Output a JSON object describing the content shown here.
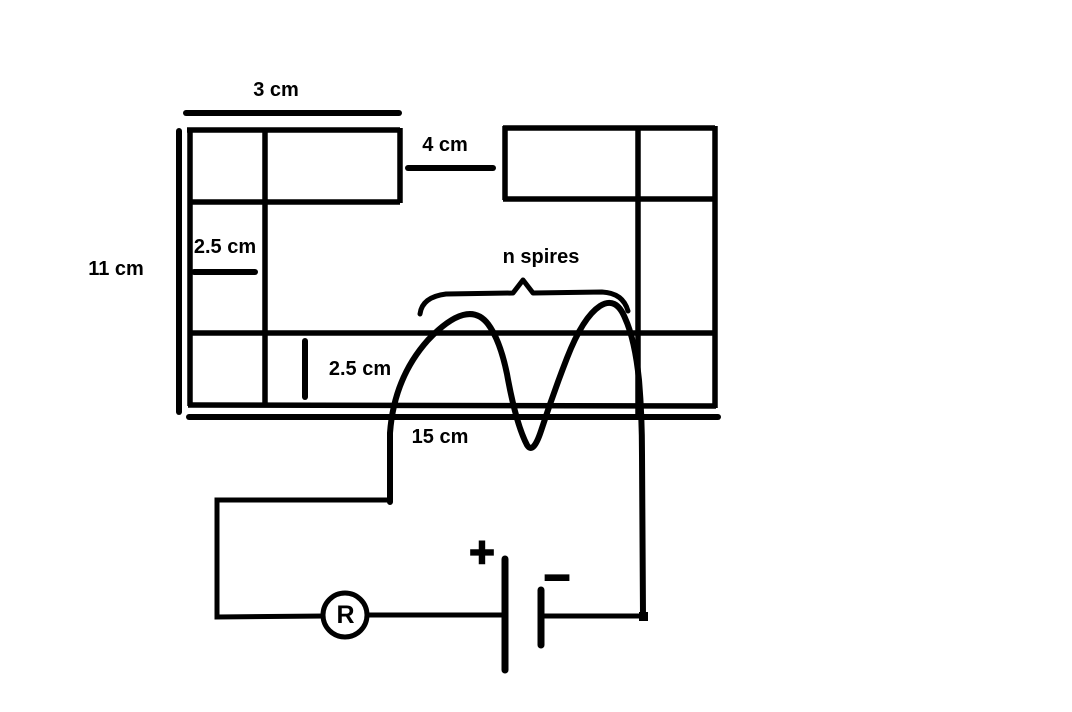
{
  "canvas": {
    "background": "#ffffff",
    "ink": "#000000"
  },
  "core": {
    "dimension_labels": {
      "top_segment_width": "3 cm",
      "air_gap_width": "4 cm",
      "left_limb_width": "2.5 cm",
      "total_height": "11 cm",
      "bottom_limb_thickness": "2.5 cm",
      "total_width": "15 cm"
    }
  },
  "coil": {
    "label": "n spires"
  },
  "circuit": {
    "resistor_label": "R",
    "battery_positive_sign": "+",
    "battery_negative_sign": "–"
  }
}
